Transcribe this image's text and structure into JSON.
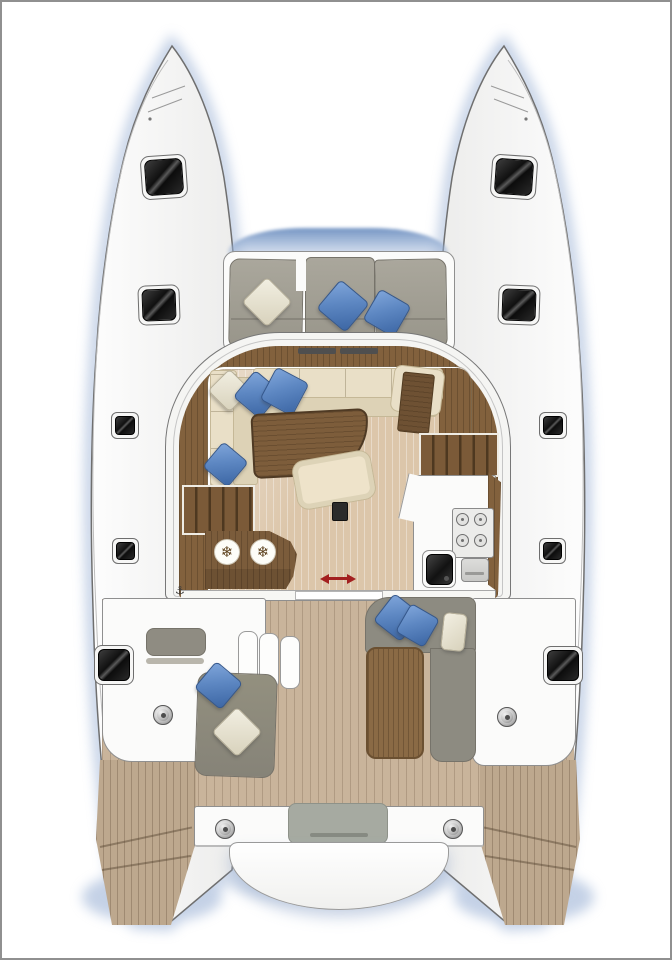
{
  "figure": {
    "type": "catamaran-deck-floorplan",
    "glyphs": {
      "fridge": "❄",
      "cleat": "⚓"
    },
    "colors": {
      "background": "#ffffff",
      "frame_border": "#909090",
      "hull_fill": "#f6f6f5",
      "hull_outline": "#6f6f6f",
      "water_shadow": "#9db3d6",
      "coachroof_window": "#6e90c1",
      "teak_deck": "#c9b49b",
      "salon_floor": "#dcc6aa",
      "walnut_wood": "#82613d",
      "cream_upholstery": "#e9dfc7",
      "gray_upholstery": "#908d83",
      "blue_pillow": "#5d87c2",
      "door_arrow_red": "#a32020",
      "hatch_glass": "#141414"
    },
    "counts": {
      "deck_hatches": 10,
      "winches": 4,
      "fridge_symbols": 2,
      "stove_burners": 4,
      "blue_pillows": 8,
      "white_pillows": 4
    },
    "components": [
      "port-hull",
      "starboard-hull",
      "trampoline-gap",
      "forward-cockpit-bench",
      "coachroof",
      "salon-lounge",
      "salon-table",
      "ottoman",
      "galley",
      "nav-station",
      "companionway-stairs-port",
      "companionway-stairs-starboard",
      "fridge-unit",
      "sliding-door",
      "aft-cockpit",
      "helm-bench",
      "chaise-lounge",
      "aft-sofa",
      "cockpit-table",
      "stern-beam",
      "tender-platform",
      "transom-steps-port",
      "transom-steps-starboard"
    ]
  }
}
